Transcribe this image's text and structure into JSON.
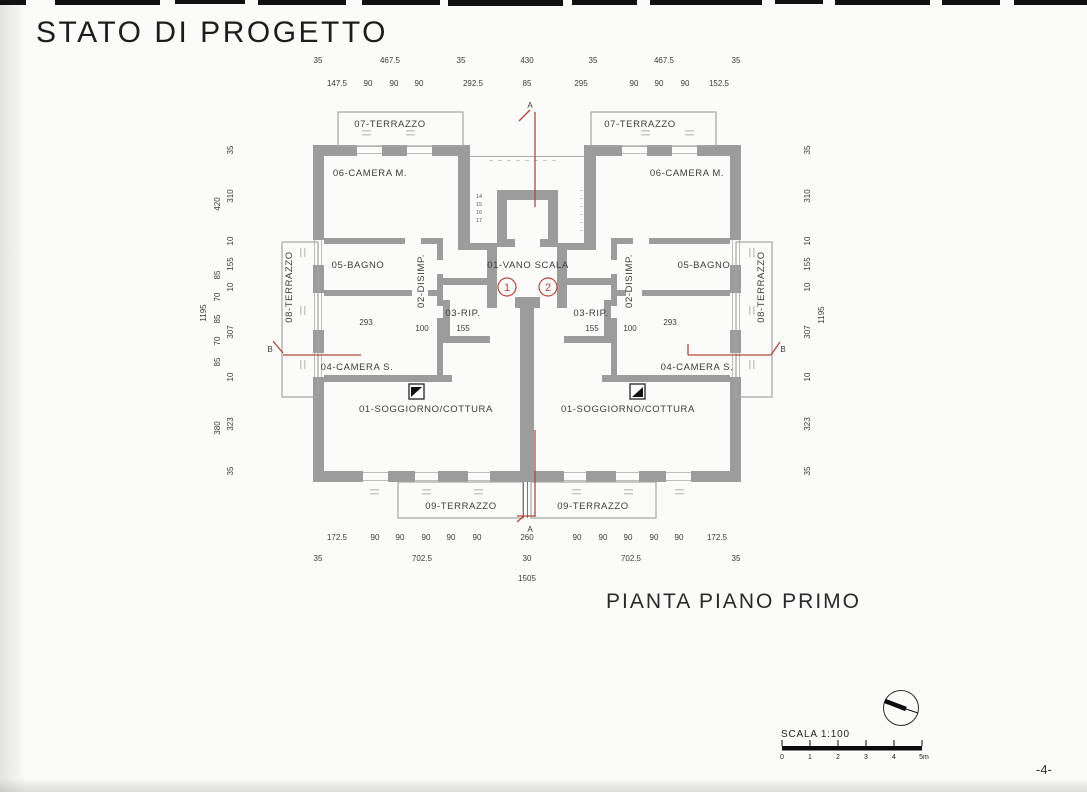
{
  "header": {
    "title": "STATO DI PROGETTO"
  },
  "plan_title": "PIANTA PIANO PRIMO",
  "footer": {
    "page_number": "-4-"
  },
  "scale_bar": {
    "label": "SCALA 1:100",
    "ticks": [
      "0",
      "1",
      "2",
      "3",
      "4",
      "5m"
    ]
  },
  "colors": {
    "wall_gray": "#9c9c9c",
    "section_red": "#b5463b",
    "paper": "#fbfbf9"
  },
  "markers": {
    "a": "A",
    "b": "B",
    "door_1": "1",
    "door_2": "2"
  },
  "rooms": {
    "center": {
      "vano_scala": "01-VANO SCALA"
    },
    "left": {
      "terrace_top": "07-TERRAZZO",
      "camera_m": "06-CAMERA M.",
      "bagno": "05-BAGNO",
      "disimp": "02-DISIMP.",
      "rip": "03-RIP.",
      "camera_s": "04-CAMERA S.",
      "soggiorno": "01-SOGGIORNO/COTTURA",
      "terrace_side": "08-TERRAZZO",
      "terrace_bottom": "09-TERRAZZO"
    },
    "right": {
      "terrace_top": "07-TERRAZZO",
      "camera_m": "06-CAMERA M.",
      "bagno": "05-BAGNO",
      "disimp": "02-DISIMP.",
      "rip": "03-RIP.",
      "camera_s": "04-CAMERA S.",
      "soggiorno": "01-SOGGIORNO/COTTURA",
      "terrace_side": "08-TERRAZZO",
      "terrace_bottom": "09-TERRAZZO"
    }
  },
  "stair_steps": [
    "14",
    "15",
    "16",
    "17"
  ],
  "dims": {
    "top1": [
      "35",
      "467.5",
      "35",
      "430",
      "35",
      "467.5",
      "35"
    ],
    "top2": [
      "147.5",
      "90",
      "90",
      "90",
      "292.5",
      "85",
      "295",
      "90",
      "90",
      "90",
      "152.5"
    ],
    "bot1": [
      "172.5",
      "90",
      "90",
      "90",
      "90",
      "90",
      "260",
      "90",
      "90",
      "90",
      "90",
      "90",
      "172.5"
    ],
    "bot2": [
      "35",
      "702.5",
      "30",
      "702.5",
      "35"
    ],
    "bot_total": "1505",
    "left_total": "1195",
    "right_total": "1195",
    "left_mid": [
      "420",
      "85",
      "70",
      "85",
      "70",
      "85",
      "380"
    ],
    "left_inner": [
      "35",
      "310",
      "10",
      "155",
      "10",
      "307",
      "10",
      "323",
      "35"
    ],
    "right_inner": [
      "35",
      "310",
      "10",
      "155",
      "10",
      "307",
      "10",
      "323",
      "35"
    ],
    "left_interior": {
      "room_w": "293",
      "disimp_w": "100",
      "rip_w": "155"
    },
    "right_interior": {
      "room_w": "293",
      "disimp_w": "100",
      "rip_w": "155"
    }
  }
}
